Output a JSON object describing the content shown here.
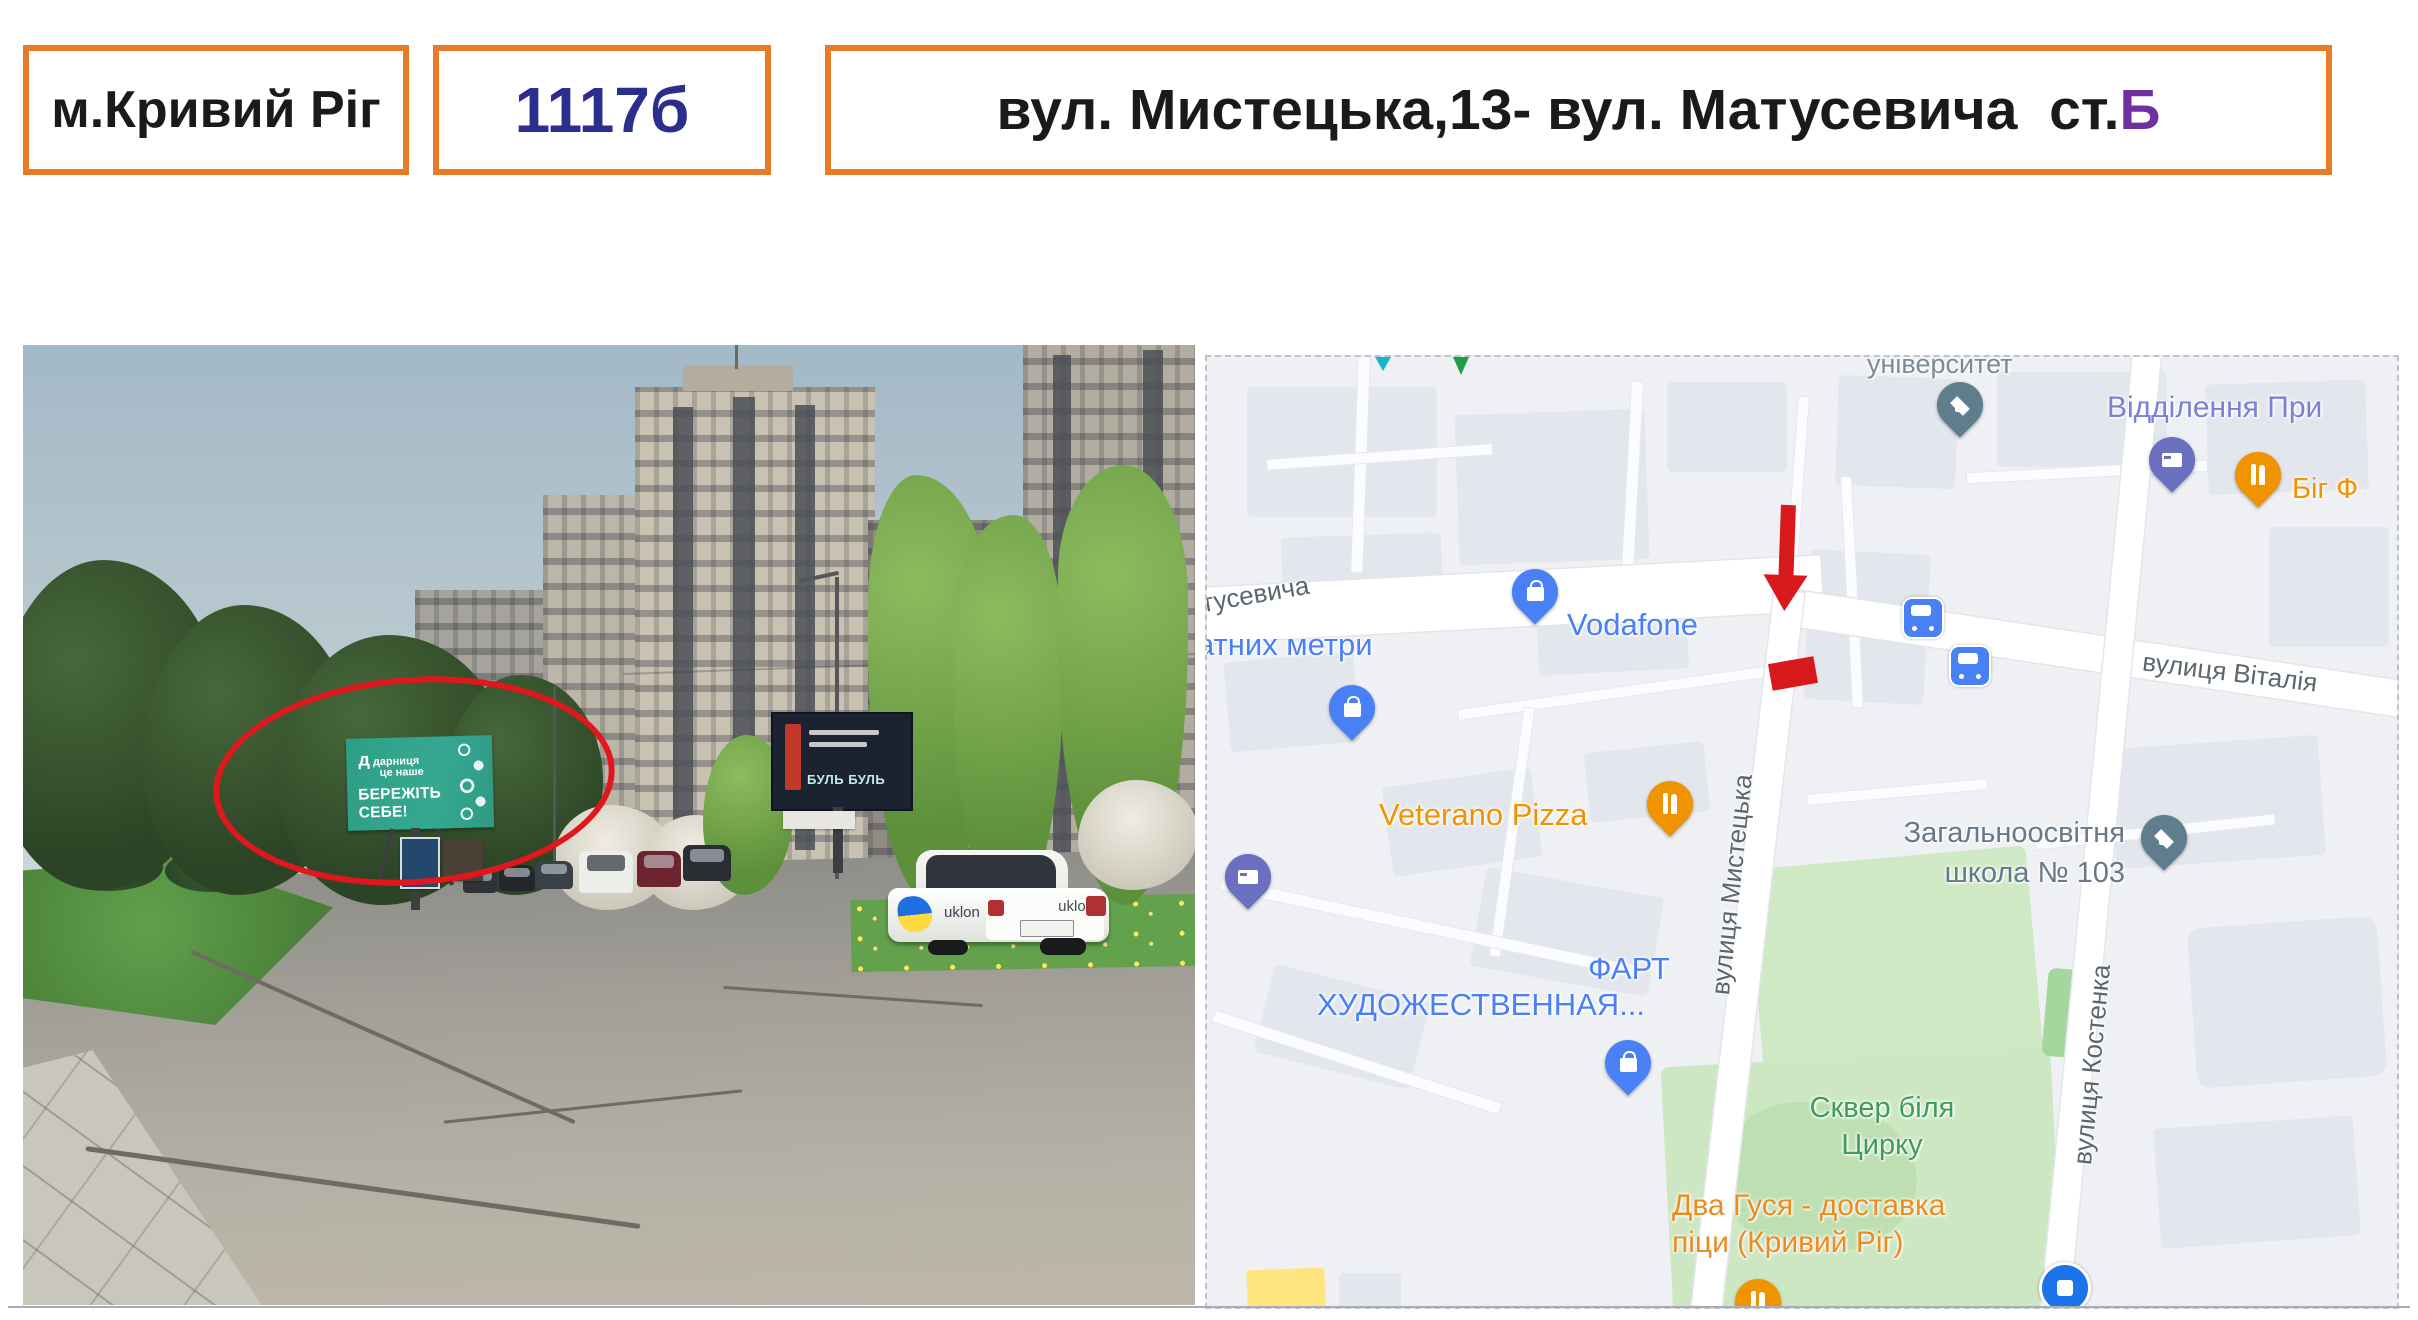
{
  "header": {
    "city": "м.Кривий Ріг",
    "board_id": "1117б",
    "address_main": "вул. Мистецька,13- вул. Матусевича  ст.",
    "address_letter": "Б"
  },
  "photo": {
    "billboard": {
      "brand_mark": "д",
      "brand": "дарниця",
      "brand_sub": "це наше",
      "slogan": "БЕРЕЖІТЬ СЕБЕ!"
    },
    "billboard2_text": "БУЛЬ БУЛЬ",
    "taxi_brand": "uklon"
  },
  "map": {
    "pois": {
      "university_label": "університет",
      "post_office_label": "Відділення При",
      "big_f_label": "Біг Ф",
      "vodafone_label": "Vodafone",
      "metry_label": "атних метри",
      "veterano_label": "Veterano Pizza",
      "school_line1": "Загальноосвітня",
      "school_line2": "школа № 103",
      "fart_line1": "ФАРТ",
      "fart_line2": "ХУДОЖЕСТВЕННАЯ...",
      "skver_line1": "Сквер біля",
      "skver_line2": "Цирку",
      "gusya_line1": "Два Гуся - доставка",
      "gusya_line2": "піци (Кривий Ріг)"
    },
    "streets": {
      "matusevycha": "тусевича",
      "mystetska": "вулиця Мистецька",
      "vitaliya": "вулиця Віталія",
      "kostenka": "вулиця Костенка"
    }
  },
  "colors": {
    "box_border_orange": "#E87B28",
    "board_id_blue": "#2B2E8C",
    "station_letter_purple": "#7030A0",
    "marker_red": "#D7191C",
    "ellipse_red": "#E0171D",
    "billboard_teal": "#2F9E86",
    "map_poi_blue": "#4A80F5",
    "map_poi_orange": "#F09300",
    "map_park_green": "#3F9D58",
    "map_school_slate": "#66788A",
    "map_post_periwinkle": "#7B80D6"
  }
}
